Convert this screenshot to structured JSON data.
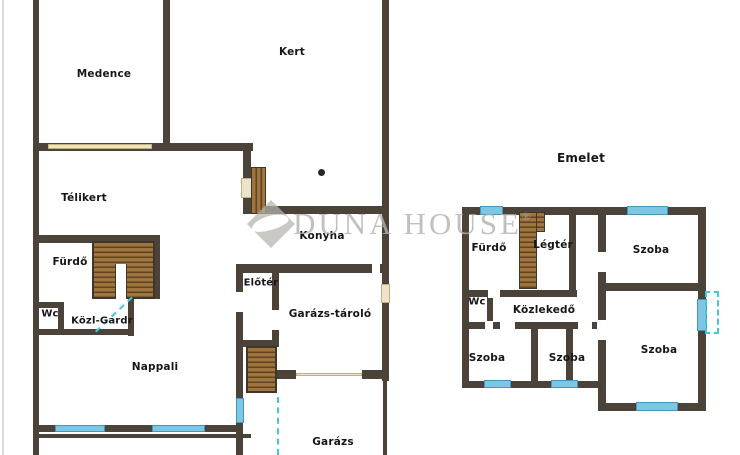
{
  "colors": {
    "wall": "#4b4339",
    "stair_fill": "#a0743d",
    "stair_tread": "#5d4524",
    "window_blue": "#7dc6e4",
    "door_cream": "#ece3c9",
    "marker_cyan": "#45c7d6",
    "watermark_gray": "#b3b1ae",
    "label_text": "#161616",
    "background": "#ffffff"
  },
  "watermark": {
    "brand": "DUNA HOUSE",
    "registered": "®"
  },
  "ground_floor": {
    "rooms": [
      {
        "id": "medence",
        "label": "Medence"
      },
      {
        "id": "kert",
        "label": "Kert"
      },
      {
        "id": "telikert",
        "label": "Télikert"
      },
      {
        "id": "furdo",
        "label": "Fürdő"
      },
      {
        "id": "wc",
        "label": "Wc"
      },
      {
        "id": "kozl-gardr",
        "label": "Közl-Gardr"
      },
      {
        "id": "nappali",
        "label": "Nappali"
      },
      {
        "id": "konyha",
        "label": "Konyha"
      },
      {
        "id": "eloter",
        "label": "Előtér"
      },
      {
        "id": "garazs-tarolo",
        "label": "Garázs-tároló"
      },
      {
        "id": "garazs",
        "label": "Garázs"
      }
    ]
  },
  "upper_floor": {
    "title": "Emelet",
    "rooms": [
      {
        "id": "furdo",
        "label": "Fürdő"
      },
      {
        "id": "legter",
        "label": "Légtér"
      },
      {
        "id": "szoba-top-right",
        "label": "Szoba"
      },
      {
        "id": "wc",
        "label": "Wc"
      },
      {
        "id": "kozlekedo",
        "label": "Közlekedő"
      },
      {
        "id": "szoba-bottom-left",
        "label": "Szoba"
      },
      {
        "id": "szoba-bottom-middle",
        "label": "Szoba"
      },
      {
        "id": "szoba-right",
        "label": "Szoba"
      }
    ]
  }
}
